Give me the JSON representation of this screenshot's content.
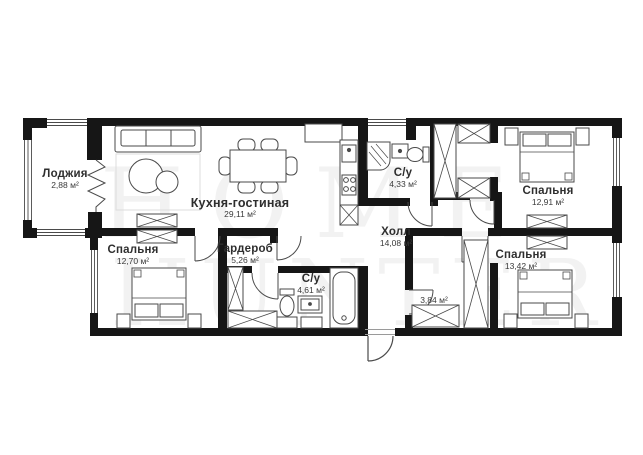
{
  "plan_title": "apartment-floor-plan",
  "watermark": {
    "line1": "HOME",
    "line2": "HUNTER"
  },
  "rooms": {
    "loggia": {
      "name": "Лоджия",
      "area": "2,88 м²"
    },
    "kitchen_living": {
      "name": "Кухня-гостиная",
      "area": "29,11 м²"
    },
    "bedroom_left": {
      "name": "Спальня",
      "area": "12,70 м²"
    },
    "wardrobe": {
      "name": "Гардероб",
      "area": "5,26 м²"
    },
    "bathroom_top": {
      "name": "С/у",
      "area": "4,33 м²"
    },
    "bathroom_bottom": {
      "name": "С/у",
      "area": "4,61 м²"
    },
    "hall": {
      "name": "Холл",
      "area": "14,08 м²"
    },
    "closet": {
      "name": "",
      "area": "3,84 м²"
    },
    "bedroom_top_right": {
      "name": "Спальня",
      "area": "12,91 м²"
    },
    "bedroom_bot_right": {
      "name": "Спальня",
      "area": "13,42 м²"
    }
  },
  "colors": {
    "wall": "#161616",
    "line": "#4a4a4a",
    "light_line": "#9a9a9a",
    "label": "#2e2e2e"
  }
}
